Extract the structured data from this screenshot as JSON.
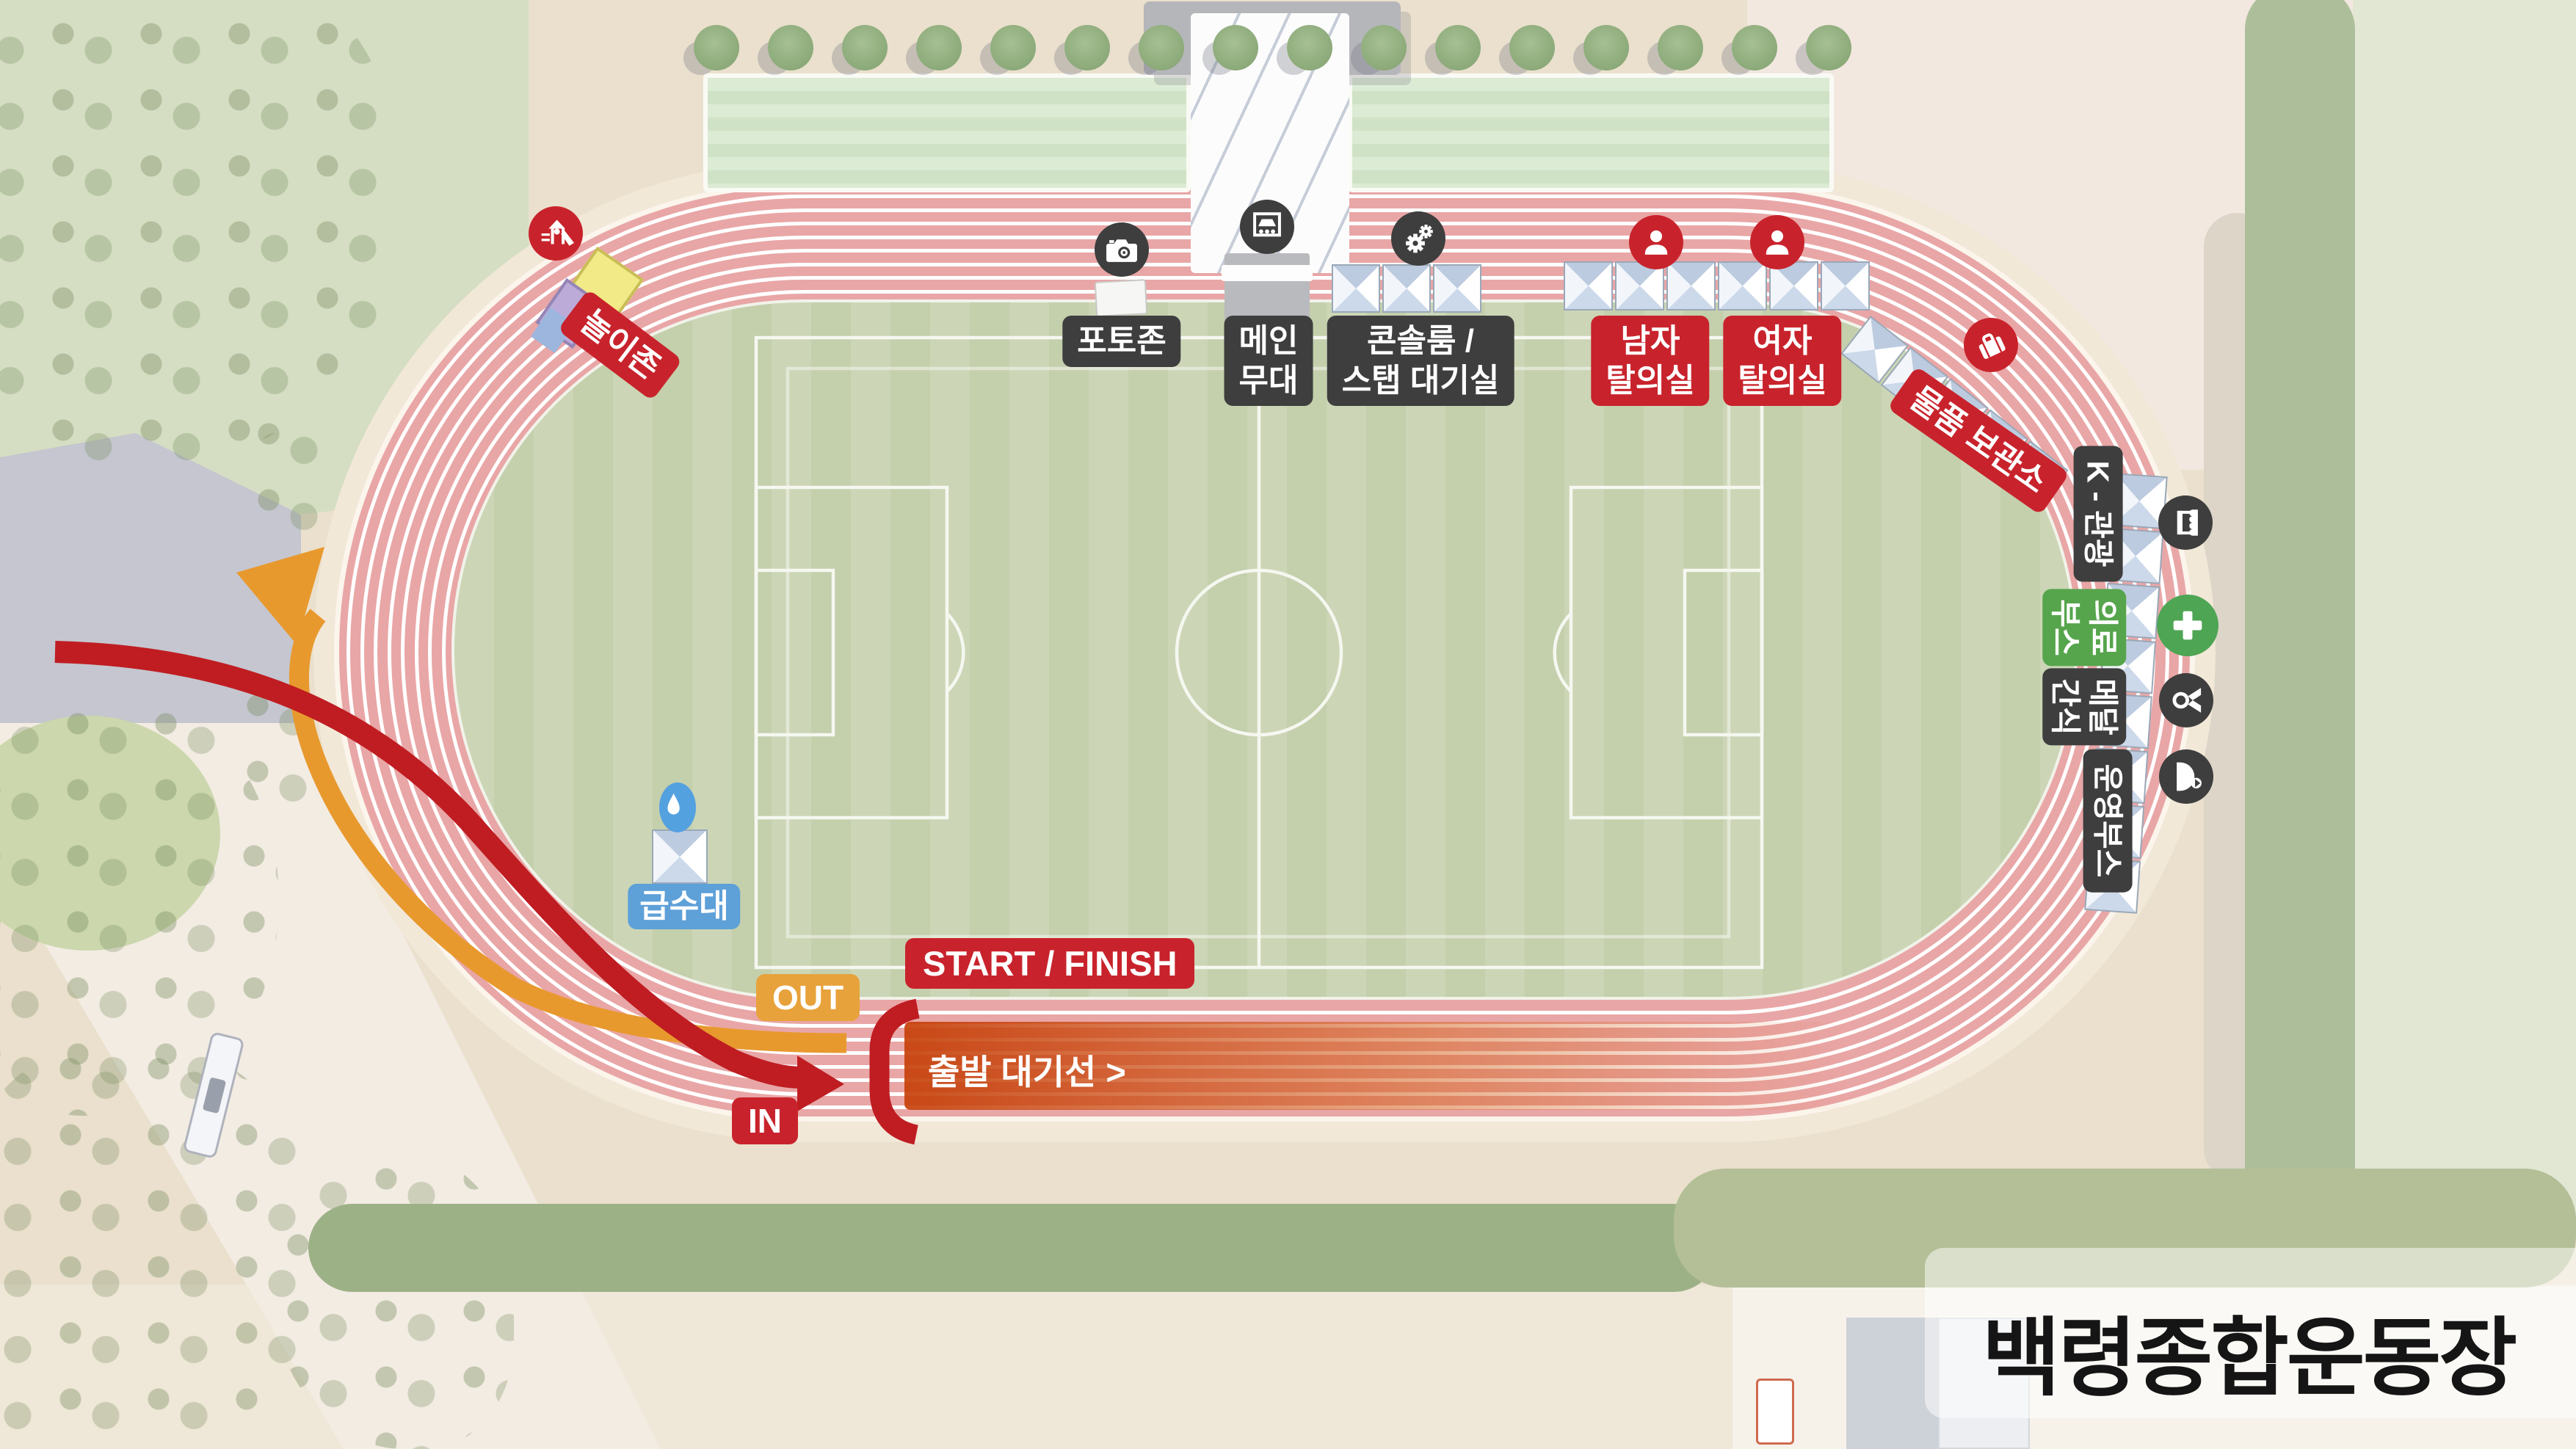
{
  "title": "백령종합운동장",
  "facilities": {
    "play_zone": {
      "label": "놀이존",
      "icon": "playground-icon",
      "color": "#c8232c"
    },
    "photo_zone": {
      "label": "포토존",
      "icon": "camera-icon",
      "color": "#3e3e3e"
    },
    "main_stage": {
      "label": "메인\n무대",
      "icon": "stage-icon",
      "color": "#3e3e3e"
    },
    "console_room": {
      "label": "콘솔룸 /\n스탭 대기실",
      "icon": "gears-icon",
      "color": "#3e3e3e"
    },
    "men_locker": {
      "label": "남자\n탈의실",
      "icon": "person-icon",
      "color": "#c8232c"
    },
    "women_locker": {
      "label": "여자\n탈의실",
      "icon": "person-icon",
      "color": "#c8232c"
    },
    "storage": {
      "label": "물품 보관소",
      "icon": "suitcase-icon",
      "color": "#c8232c"
    },
    "k_tour_booth": {
      "label": "K - 관광",
      "icon": "booth-icon",
      "color": "#3e3e3e"
    },
    "medical_booth": {
      "label": "의료\n부스",
      "icon": "medical-cross-icon",
      "color": "#56a54c"
    },
    "medal_snack": {
      "label": "메달\n간식",
      "icon": "medal-icon",
      "color": "#3e3e3e"
    },
    "operation_booth": {
      "label": "운영부스",
      "icon": "operation-staff-icon",
      "color": "#3e3e3e"
    },
    "water_station": {
      "label": "급수대",
      "icon": "water-drop-icon",
      "color": "#5ea0d8"
    }
  },
  "route": {
    "start_finish_label": "START / FINISH",
    "out_label": "OUT",
    "in_label": "IN",
    "waiting_line_label": "출발 대기선 >"
  },
  "colors": {
    "label_red": "#c8232c",
    "label_dark": "#3e3e3e",
    "label_green": "#56a54c",
    "label_blue": "#5ea0d8",
    "label_orange": "#e8a23b",
    "arrow_out_orange": "#e8992e",
    "arrow_in_red": "#bf1d22",
    "track_pink": "#e9a6a6",
    "infield_green": "#ccd6b6",
    "waiting_band_orange": "#cc4b10"
  }
}
